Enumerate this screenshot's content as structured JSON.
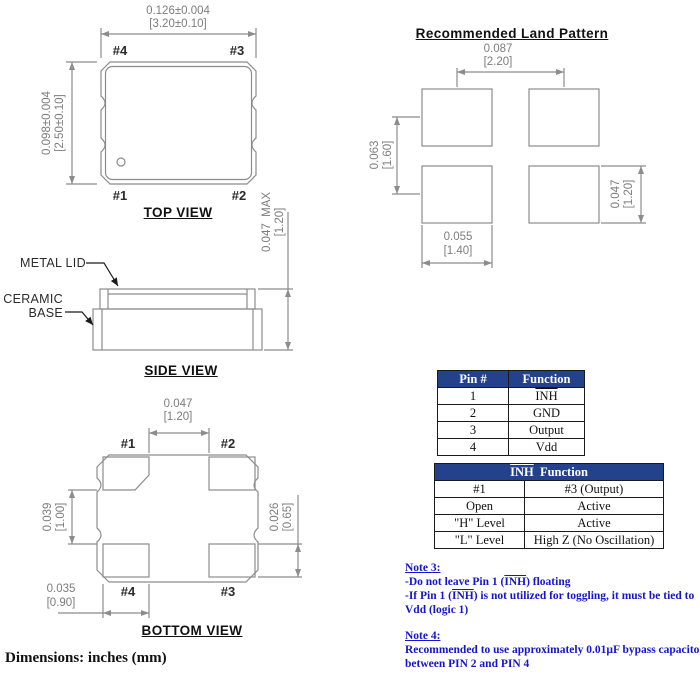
{
  "colors": {
    "drawing_line": "#8c8c8c",
    "dimension_text": "#7d7d7d",
    "table_header_bg": "#24418c",
    "table_header_text": "#ffffff",
    "note_text": "#1515cd"
  },
  "top_view": {
    "title": "TOP VIEW",
    "width_dim_in": "0.126±0.004",
    "width_dim_mm": "[3.20±0.10]",
    "height_dim_in": "0.098±0.004",
    "height_dim_mm": "[2.50±0.10]",
    "pin_top_left": "#4",
    "pin_top_right": "#3",
    "pin_bottom_left": "#1",
    "pin_bottom_right": "#2"
  },
  "side_view": {
    "title": "SIDE VIEW",
    "metal_lid_label": "METAL LID",
    "ceramic_base_label_line1": "CERAMIC",
    "ceramic_base_label_line2": "BASE",
    "height_dim_in": "0.047  MAX",
    "height_dim_mm": "[1.20]"
  },
  "bottom_view": {
    "title": "BOTTOM VIEW",
    "pin_top_left": "#1",
    "pin_top_right": "#2",
    "pin_bottom_left": "#4",
    "pin_bottom_right": "#3",
    "pad_gap_dim_in": "0.047",
    "pad_gap_dim_mm": "[1.20]",
    "left_gap_dim_in": "0.039",
    "left_gap_dim_mm": "[1.00]",
    "pad_height_dim_in": "0.026",
    "pad_height_dim_mm": "[0.65]",
    "pad_width_dim_in": "0.035",
    "pad_width_dim_mm": "[0.90]"
  },
  "land_pattern": {
    "title": "Recommended Land Pattern",
    "h_pitch_in": "0.087",
    "h_pitch_mm": "[2.20]",
    "v_pitch_in": "0.063",
    "v_pitch_mm": "[1.60]",
    "pad_width_in": "0.055",
    "pad_width_mm": "[1.40]",
    "pad_height_in": "0.047",
    "pad_height_mm": "[1.20]"
  },
  "pin_table": {
    "headers": [
      "Pin #",
      "Function"
    ],
    "rows": [
      {
        "pin": "1",
        "function": "INH"
      },
      {
        "pin": "2",
        "function": "GND"
      },
      {
        "pin": "3",
        "function": "Output"
      },
      {
        "pin": "4",
        "function": "Vdd"
      }
    ]
  },
  "inh_table": {
    "header_inh": "INH",
    "header_rest": "  Function",
    "col_headers": [
      "#1",
      "#3 (Output)"
    ],
    "rows": [
      [
        "Open",
        "Active"
      ],
      [
        "\"H\" Level",
        "Active"
      ],
      [
        "\"L\" Level",
        "High Z (No Oscillation)"
      ]
    ]
  },
  "notes": {
    "note3_title": "Note 3:",
    "note3_line1_pre": "-Do not leave Pin 1 (",
    "note3_line1_inh": "INH",
    "note3_line1_post": ") floating",
    "note3_line2_pre": "-If Pin 1 (",
    "note3_line2_inh": "INH",
    "note3_line2_post": ") is not utilized for toggling, it must be tied to Vdd (logic 1)",
    "note4_title": "Note 4:",
    "note4_body": "Recommended to use approximately 0.01µF bypass capacitor between PIN 2 and PIN 4"
  },
  "footer": {
    "dimensions_label": "Dimensions: inches (mm)"
  }
}
